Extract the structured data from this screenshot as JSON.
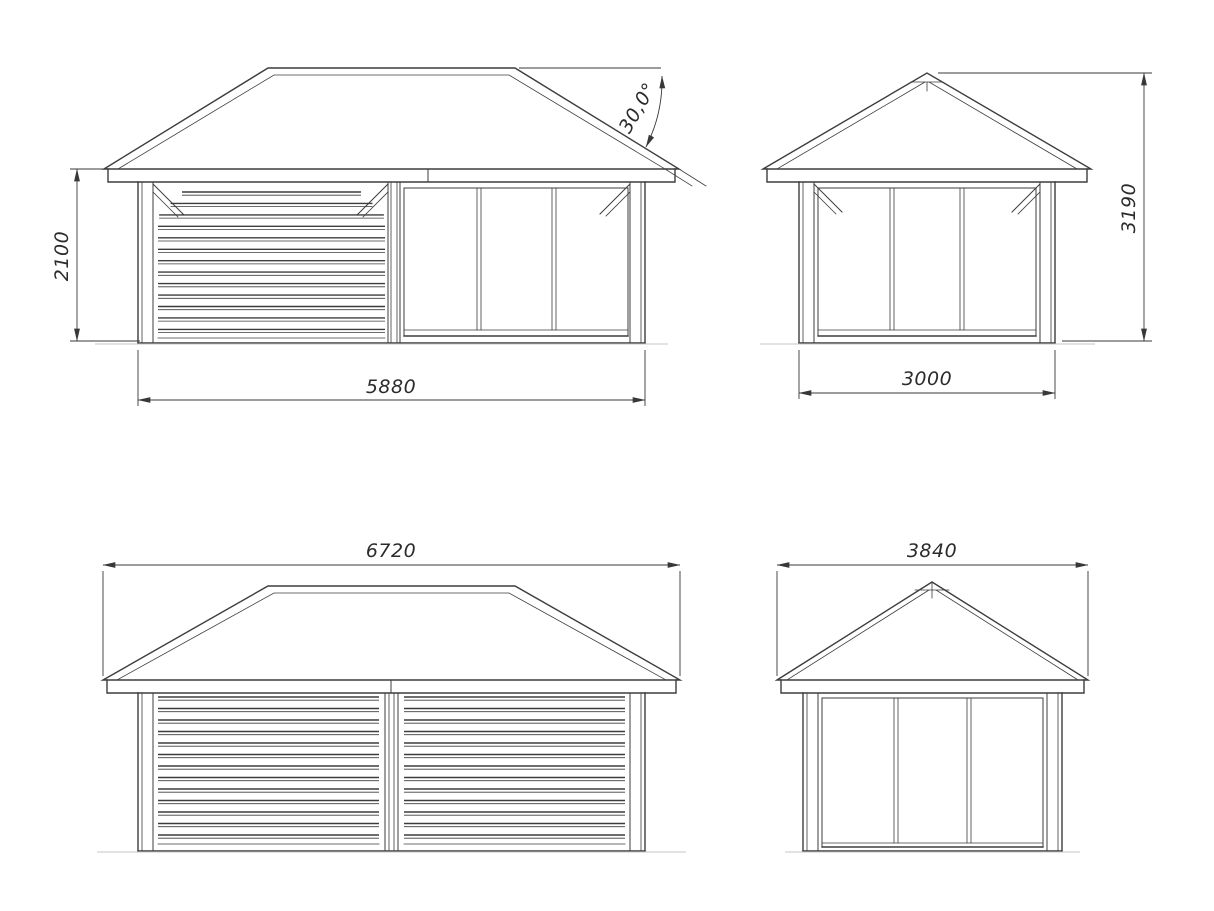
{
  "colors": {
    "line": "#3d3d3d",
    "dimension_text": "#2b2b2b",
    "ground_line": "#c6c6c6",
    "background": "#ffffff"
  },
  "views": {
    "front_elevation": {
      "height_dim": "2100",
      "width_dim": "5880",
      "roof_angle_dim": "30,0°"
    },
    "right_side_elevation": {
      "width_dim": "3000",
      "height_dim": "3190"
    },
    "rear_elevation": {
      "roof_width_dim": "6720"
    },
    "left_side_elevation": {
      "roof_width_dim": "3840"
    }
  }
}
